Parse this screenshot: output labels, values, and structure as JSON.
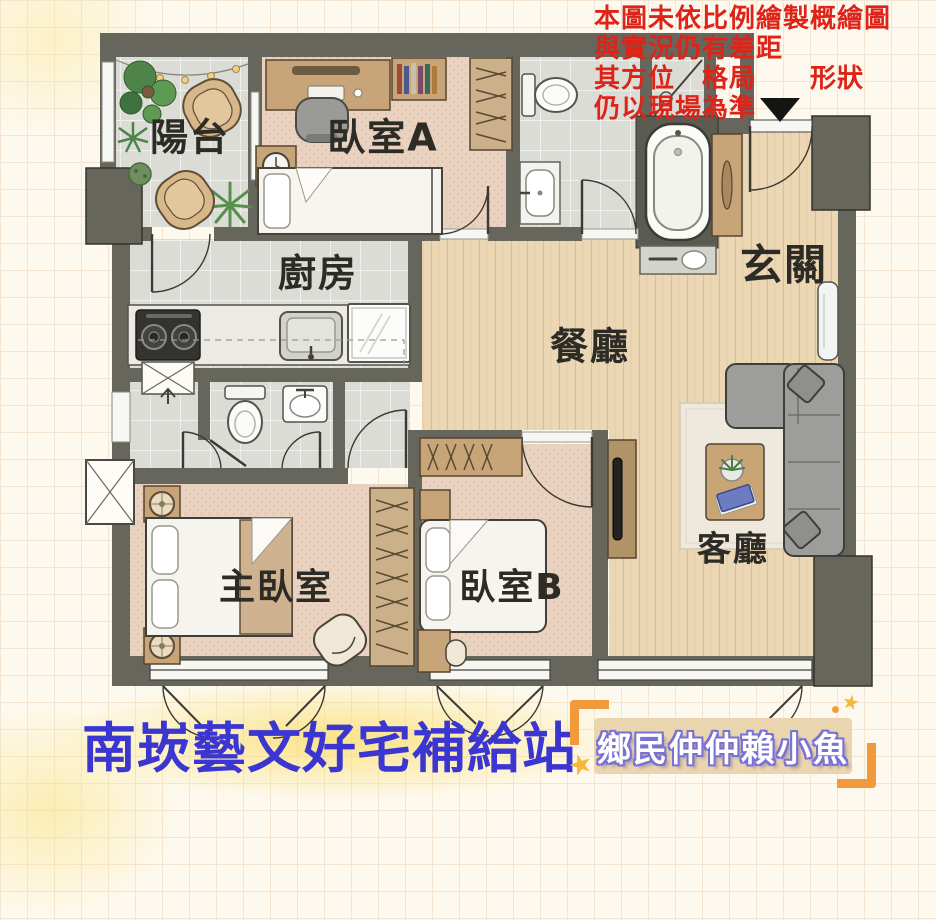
{
  "disclaimer": {
    "lines": [
      "本圖未依比例繪製概繪圖",
      "與實況仍有差距",
      "其方位　格局　　形狀",
      "仍以現場為準"
    ],
    "color": "#de2418"
  },
  "rooms": {
    "balcony": "陽台",
    "bedroom_a": "臥室A",
    "kitchen": "廚房",
    "dining": "餐廳",
    "entry": "玄關",
    "master_bedroom": "主臥室",
    "bedroom_b": "臥室B",
    "living": "客廳"
  },
  "footer": {
    "title": "南崁藝文好宅補給站",
    "badge": "鄉民仲仲賴小魚",
    "star_glyph": "★"
  },
  "icons": {
    "entrance_marker": "down-triangle",
    "vent_shaft": "x-box",
    "direction_arrow": "up-arrow"
  },
  "colors": {
    "wall": "#67665d",
    "wood_floor": "#ecd7b5",
    "carpet": "#e9d2bf",
    "tile": "#dcdcd7",
    "accent_red": "#de2418",
    "title_blue": "#3b36d2",
    "badge_bg": "#ead6ae",
    "badge_text_outline": "#7a71d4",
    "bracket_orange": "#f09a3c",
    "star_yellow": "#f5b83a",
    "sofa_gray": "#9d9d9b",
    "furniture_wood": "#c7a578"
  }
}
